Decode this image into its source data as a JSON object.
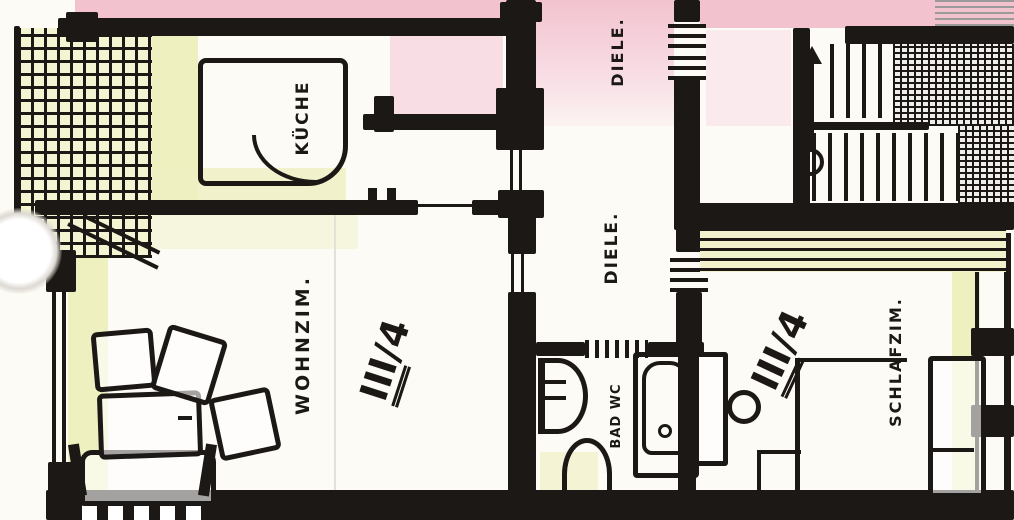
{
  "document": {
    "type": "hand-drawn apartment floor plan (scanned sketch)",
    "apartment_id": "III/4"
  },
  "colors": {
    "ink": "#1c1815",
    "pink_wash": "#f2c3cf",
    "yellow_wash": "#eef0c0",
    "paper": "#fcfbf5"
  },
  "rooms": {
    "kueche": {
      "label": "KÜCHE"
    },
    "diele_top": {
      "label": "DIELE."
    },
    "diele_mitte": {
      "label": "DIELE."
    },
    "wohnzimmer": {
      "label": "WOHNZIM."
    },
    "bad": {
      "label": "BAD WC"
    },
    "schlafzimmer": {
      "label": "SCHLAFZIM."
    }
  },
  "units": {
    "left": {
      "floor": "III",
      "suffix": "/4"
    },
    "right": {
      "floor": "III",
      "suffix": "/4"
    }
  }
}
